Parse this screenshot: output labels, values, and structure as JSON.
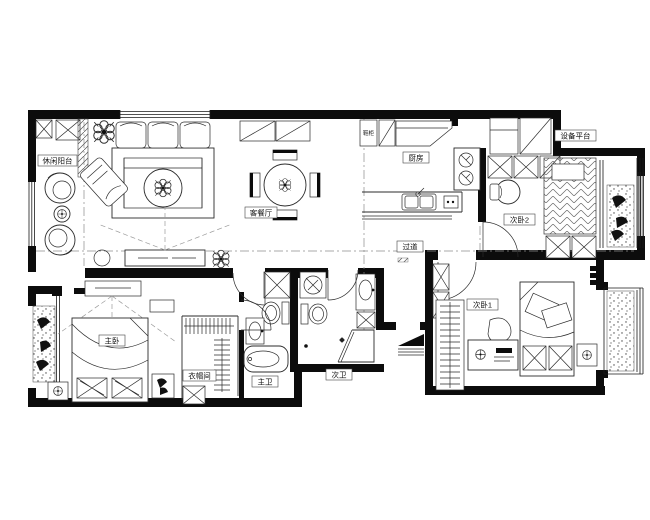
{
  "meta": {
    "drawing_type": "apartment-floor-plan"
  },
  "colors": {
    "wall": "#0c0c0c",
    "line": "#2b2b2b",
    "dash": "#8c8c8c",
    "background": "#ffffff"
  },
  "rooms": {
    "leisure_balcony": {
      "label": "休闲阳台"
    },
    "living_dining": {
      "label": "客餐厅"
    },
    "kitchen": {
      "label": "厨房"
    },
    "equipment_platform": {
      "label": "设备平台"
    },
    "bedroom2": {
      "label": "次卧2"
    },
    "corridor": {
      "label": "过道"
    },
    "bedroom1": {
      "label": "次卧1"
    },
    "master_bedroom": {
      "label": "主卧"
    },
    "cloakroom": {
      "label": "衣帽间"
    },
    "master_bath": {
      "label": "主卫"
    },
    "second_bath": {
      "label": "次卫"
    },
    "entry": {
      "shoe_cabinet_label": "鞋柜"
    }
  }
}
